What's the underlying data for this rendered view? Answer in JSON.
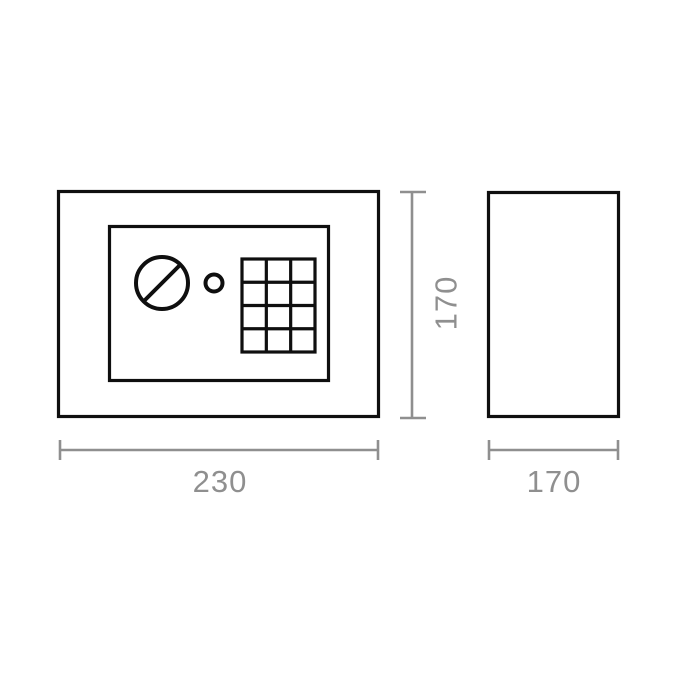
{
  "drawing": {
    "colors": {
      "outline_black": "#0f0f0f",
      "dimension_gray": "#8f8f8f",
      "background": "#ffffff"
    },
    "front_view": {
      "width_label": "230",
      "height_label": "170",
      "keypad": {
        "columns": 3,
        "rows": 4
      }
    },
    "side_view": {
      "depth_label": "170"
    }
  }
}
